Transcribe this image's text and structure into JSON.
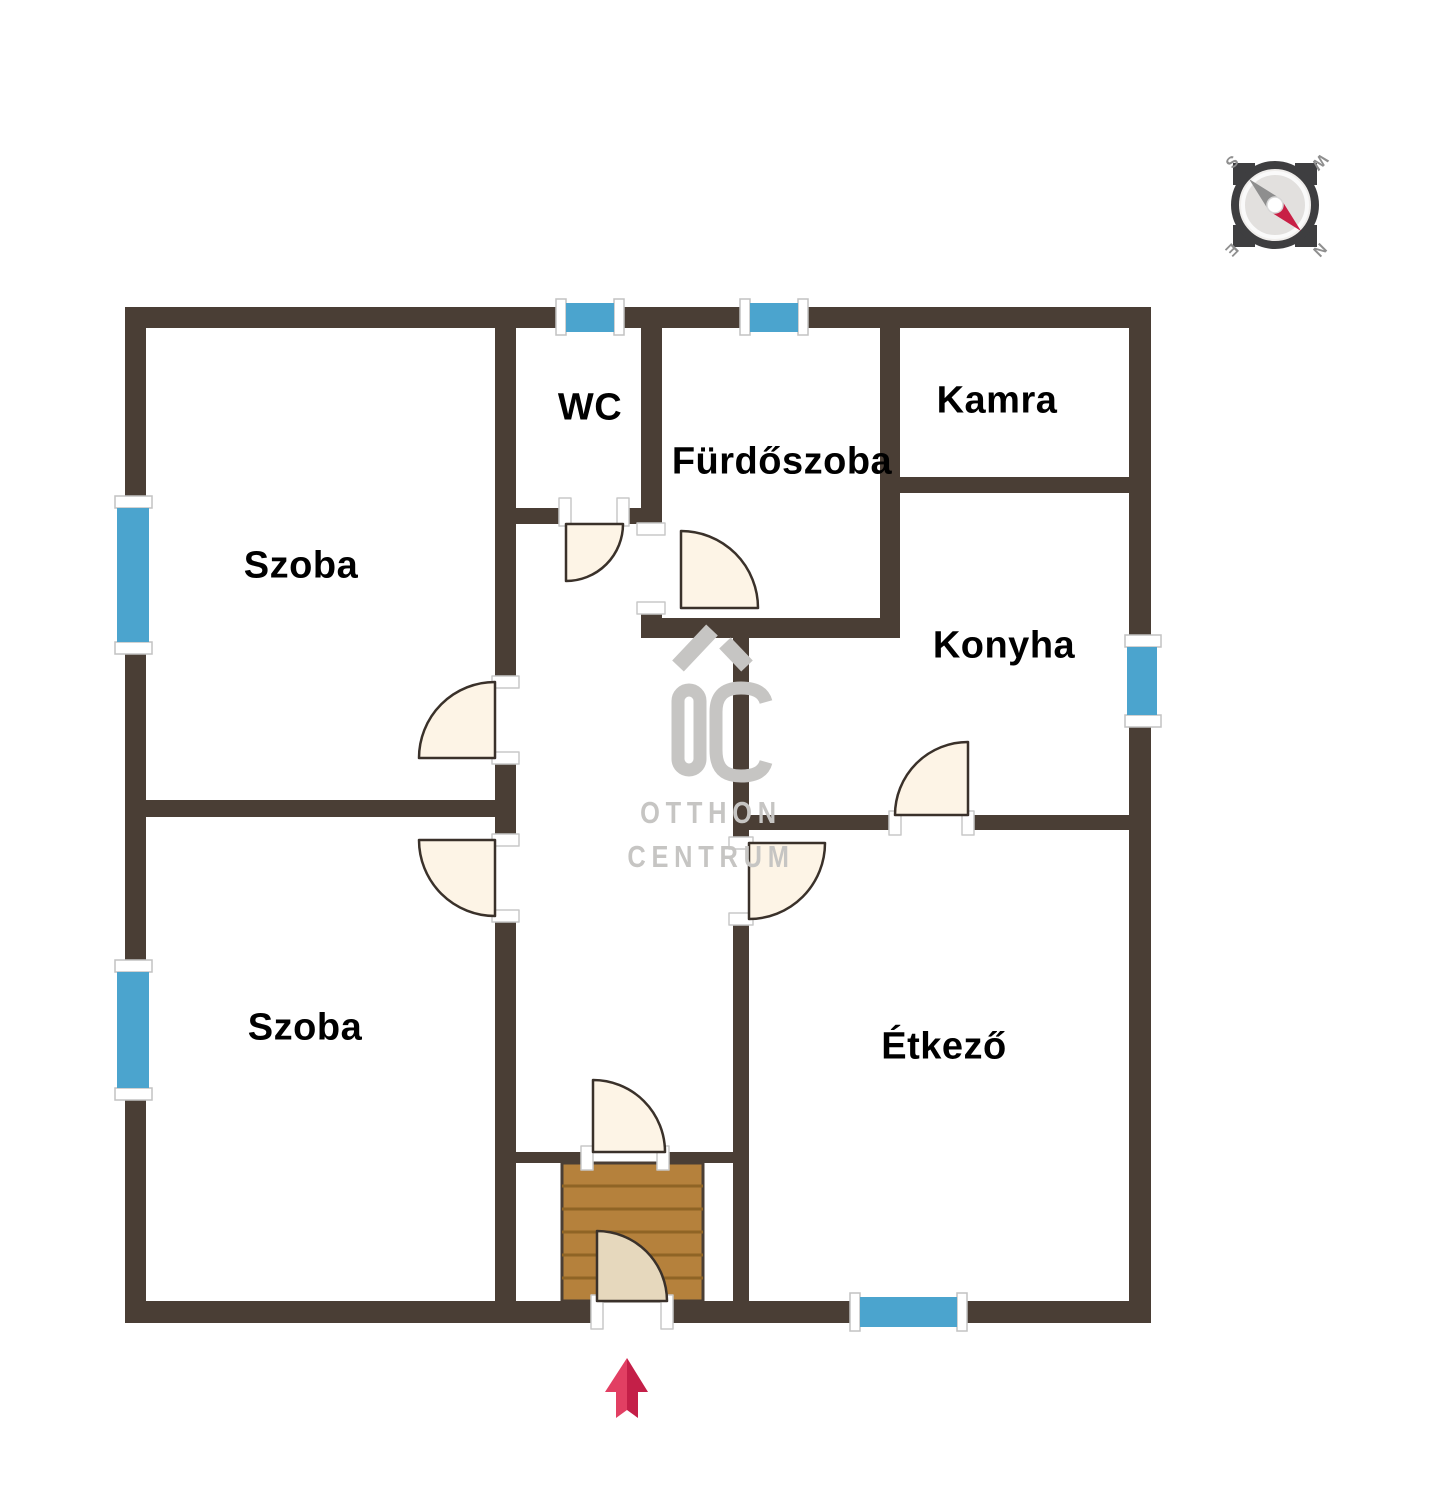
{
  "floorplan": {
    "rooms": {
      "wc": {
        "label": "WC"
      },
      "furdoszoba": {
        "label": "Fürdőszoba"
      },
      "kamra": {
        "label": "Kamra"
      },
      "konyha": {
        "label": "Konyha"
      },
      "szoba_top": {
        "label": "Szoba"
      },
      "szoba_bottom": {
        "label": "Szoba"
      },
      "etkezo": {
        "label": "Étkező"
      }
    },
    "colors": {
      "wall": "#4a3e35",
      "window_blue": "#4ba4ce",
      "door_fill": "#fdf4e6",
      "entrance_door_fill": "#e6d8bd",
      "door_stroke": "#3a312a",
      "stairs_fill": "#b5813c",
      "stairs_line": "#8f6425",
      "arrow_left": "#e23f63",
      "arrow_right": "#c41f48",
      "watermark_gray": "#c6c5c3",
      "compass_dark": "#3e3e40",
      "compass_red": "#c81f45"
    },
    "counts": {
      "windows": 6,
      "doors": 8
    }
  },
  "watermark": {
    "logo": "OC",
    "line1": "OTTHON",
    "line2": "CENTRUM"
  },
  "compass": {
    "letters": {
      "top_left": "S",
      "top_right": "W",
      "bottom_left": "E",
      "bottom_right": "N"
    }
  },
  "entrance_arrow": {
    "direction": "up"
  }
}
